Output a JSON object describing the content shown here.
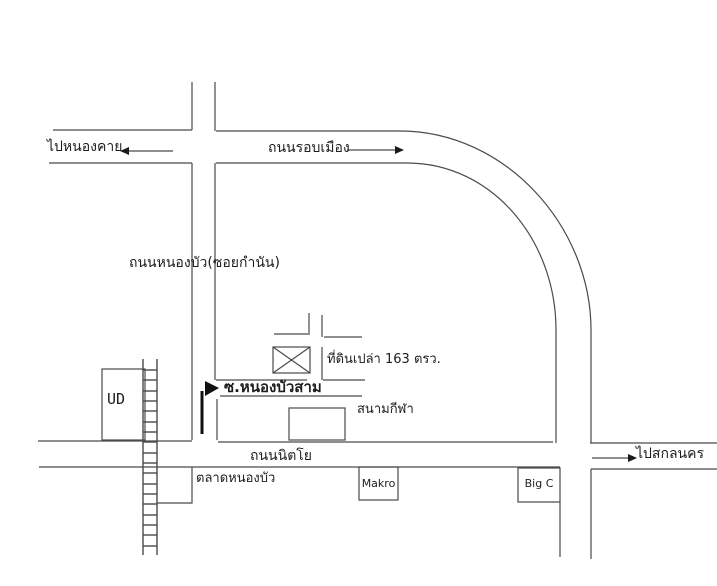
{
  "map": {
    "colors": {
      "background": "#ffffff",
      "line": "#4a4a4a",
      "text": "#1d1d1d",
      "arrow_fill": "#1a1a1a"
    },
    "roads": {
      "ring_road": "ถนนรอบเมือง",
      "nong_bua_road": "ถนนหนองบัว(ซอยกำนัน)",
      "soi_nong_bua_sam": "ซ.หนองบัวสาม",
      "nittayo_road": "ถนนนิตโย"
    },
    "destinations": {
      "to_nong_khai": "ไปหนองคาย",
      "to_sakon_nakhon": "ไปสกลนคร"
    },
    "places": {
      "ud": "UD",
      "vacant_land": "ที่ดินเปล่า 163 ตรว.",
      "stadium": "สนามกีฬา",
      "market": "ตลาดหนองบัว",
      "makro": "Makro",
      "big_c": "Big C"
    },
    "icons": {
      "west_arrow": "←",
      "east_arrow": "→",
      "soi_direction_arrow": "➔",
      "sakon_arrow": "→",
      "railway_track": "ladder-track",
      "vacant_land_marker": "⊠"
    }
  }
}
